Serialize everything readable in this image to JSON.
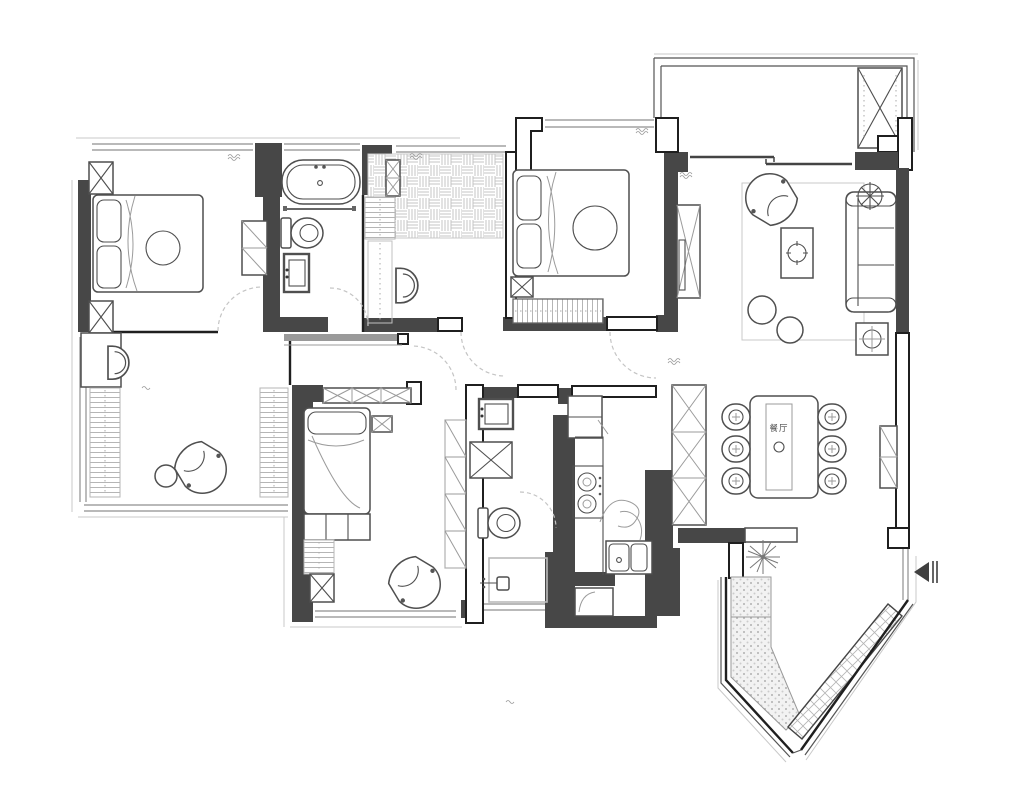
{
  "meta": {
    "title": "apartment-floor-plan",
    "canvas": {
      "width": 1024,
      "height": 797
    }
  },
  "palette": {
    "background": "#ffffff",
    "wall_fill": "#474747",
    "outline": "#1f1f1f",
    "furniture_line": "#4f4f4f",
    "light_line": "#c9c9c9",
    "window_line": "#8f8f8f",
    "dash_line": "#c4c4c4",
    "hatch_line": "#b5b5b5",
    "text_color": "#4a4a4a"
  },
  "labels": {
    "dining_table": "餐厅"
  },
  "areas": [
    "bedroom-top-left",
    "bathroom-top",
    "walk-in-closet",
    "master-bedroom",
    "balcony",
    "living-room",
    "dining-area",
    "kitchen",
    "bathroom-center",
    "bedroom-bottom-left",
    "study-lounge",
    "entry-hall"
  ],
  "icons": [
    "bed-icon",
    "pillow-icon",
    "nightstand-icon",
    "wardrobe-icon",
    "bathtub-icon",
    "toilet-icon",
    "vanity-sink-icon",
    "towel-bar-icon",
    "sofa-icon",
    "armchair-icon",
    "coffee-table-icon",
    "pouf-icon",
    "ceiling-fan-icon",
    "floor-drain-icon",
    "tv-cabinet-icon",
    "dining-table-icon",
    "dining-chair-icon",
    "storage-column-icon",
    "fridge-icon",
    "stove-icon",
    "kitchen-sink-icon",
    "washing-machine-icon",
    "shower-icon",
    "desk-icon",
    "desk-chair-icon",
    "shelf-strip-icon",
    "plant-icon",
    "shoe-bench-icon",
    "entry-arrow-icon",
    "door-swing-icon",
    "sliding-door-icon",
    "window-icon"
  ]
}
